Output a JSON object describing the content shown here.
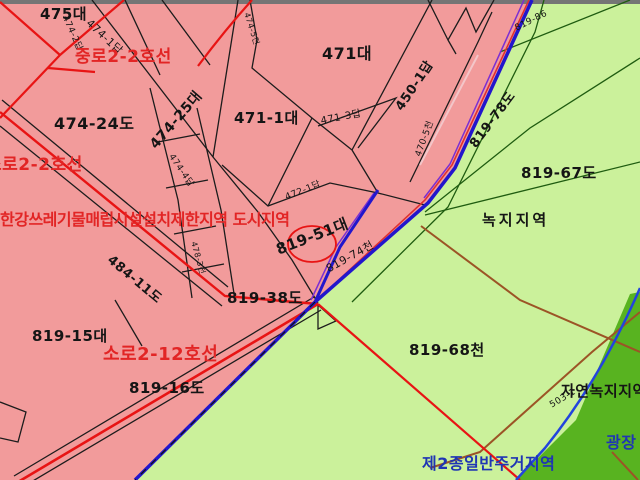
{
  "map": {
    "type": "korean-cadastral-zoning-map",
    "colors": {
      "urban_zone_pink": "#f29b9b",
      "green_zone_light": "#cbf19b",
      "green_zone_dark": "#58b320",
      "road_red": "#e81414",
      "boundary_blue": "#2216cc",
      "boundary_purple": "#7b2fd2",
      "parcel_line_black": "#1c1c1c",
      "green_line": "#1f5c10",
      "brown_line": "#9c5426",
      "label_red": "#e22525",
      "label_blue": "#1f35b4",
      "top_bar_gray": "#757575"
    },
    "labels": [
      {
        "id": "parcel-475",
        "text": "475대"
      },
      {
        "id": "parcel-474-2",
        "text": "474-2답"
      },
      {
        "id": "parcel-474-1",
        "text": "474-1답"
      },
      {
        "id": "road-jungro-2-2",
        "text": "중로2-2호선"
      },
      {
        "id": "parcel-474-24",
        "text": "474-24도"
      },
      {
        "id": "parcel-474-25",
        "text": "474-25대"
      },
      {
        "id": "parcel-474-5",
        "text": "474-5전"
      },
      {
        "id": "parcel-471",
        "text": "471대"
      },
      {
        "id": "parcel-471-1",
        "text": "471-1대"
      },
      {
        "id": "parcel-471-3",
        "text": "471-3답"
      },
      {
        "id": "parcel-450-1",
        "text": "450-1답"
      },
      {
        "id": "parcel-470-5",
        "text": "470-5천"
      },
      {
        "id": "parcel-819-78",
        "text": "819-78도"
      },
      {
        "id": "parcel-819-86",
        "text": "819-86"
      },
      {
        "id": "parcel-819-67",
        "text": "819-67도"
      },
      {
        "id": "zone-greenbelt",
        "text": "녹지지역"
      },
      {
        "id": "annotation-restriction",
        "text": "한강쓰레기물매립시설설치제한지역 도시지역"
      },
      {
        "id": "road-soro-2-2",
        "text": "소로2-2호선"
      },
      {
        "id": "parcel-472-1",
        "text": "472-1답"
      },
      {
        "id": "parcel-819-51",
        "text": "819-51대"
      },
      {
        "id": "parcel-484-11",
        "text": "484-11도"
      },
      {
        "id": "parcel-474-4",
        "text": "474-4답"
      },
      {
        "id": "parcel-478-3",
        "text": "478-3전"
      },
      {
        "id": "parcel-819-38",
        "text": "819-38도"
      },
      {
        "id": "parcel-819-15",
        "text": "819-15대"
      },
      {
        "id": "road-soro-2-12",
        "text": "소로2-12호선"
      },
      {
        "id": "parcel-819-16",
        "text": "819-16도"
      },
      {
        "id": "parcel-819-68",
        "text": "819-68천"
      },
      {
        "id": "parcel-819-74",
        "text": "819-74천"
      },
      {
        "id": "zone-natural-green",
        "text": "자연녹지지역"
      },
      {
        "id": "parcel-503-1",
        "text": "503-1"
      },
      {
        "id": "zone-plaza",
        "text": "광장"
      },
      {
        "id": "zone-residential2",
        "text": "제2종일반주거지역"
      }
    ]
  }
}
